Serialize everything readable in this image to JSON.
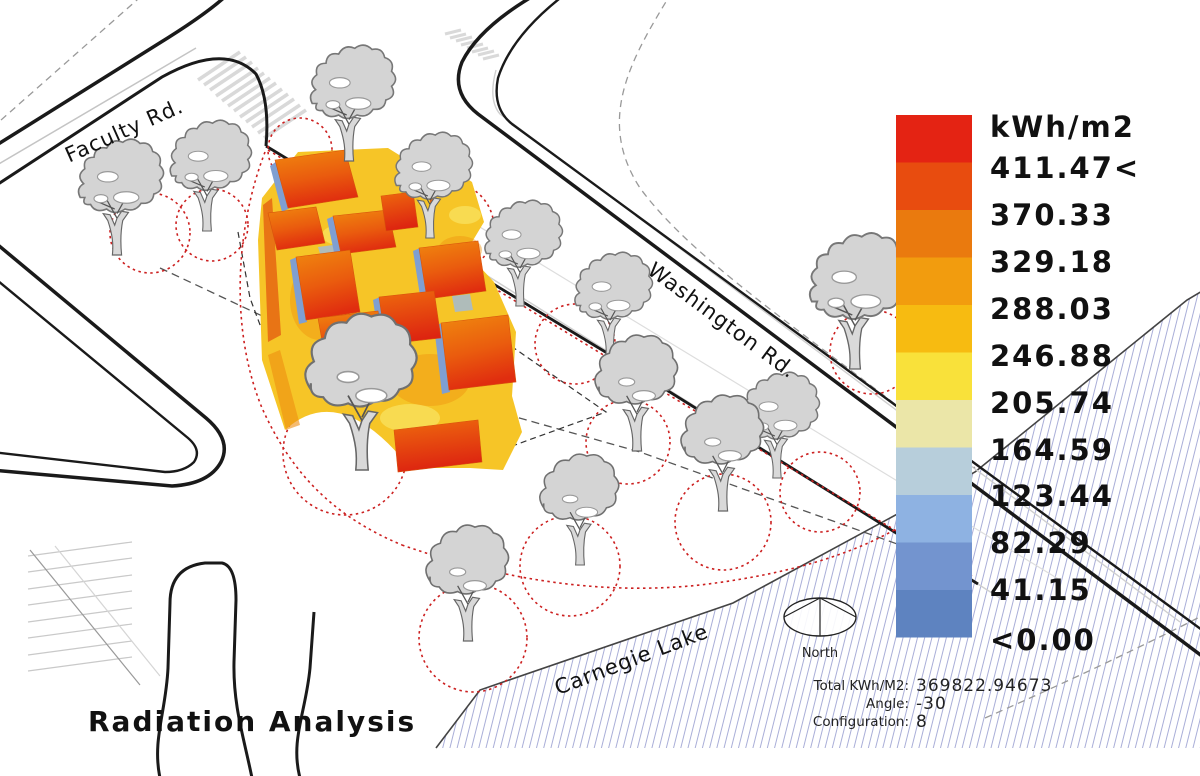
{
  "title": "Radiation Analysis",
  "legend": {
    "unit_label": "kWh/m2",
    "entries": [
      "411.47<",
      "370.33",
      "329.18",
      "288.03",
      "246.88",
      "205.74",
      "164.59",
      "123.44",
      "82.29",
      "41.15",
      "<0.00"
    ],
    "colors": [
      "#e42313",
      "#e84c0f",
      "#ea7a0e",
      "#f29c0e",
      "#f7bb11",
      "#f9e13a",
      "#ebe6a8",
      "#b7cedb",
      "#8eb2e2",
      "#7394cf",
      "#5e83c0"
    ]
  },
  "map_labels": {
    "road_top_left": "Faculty Rd.",
    "road_right": "Washington Rd.",
    "lake": "Carnegie Lake",
    "compass": "North"
  },
  "stats": {
    "total_label": "Total KWh/M2:",
    "total_value": "369822.94673",
    "angle_label": "Angle:",
    "angle_value": "-30",
    "config_label": "Configuration:",
    "config_value": "8"
  },
  "palette": {
    "site_ground": "#f6c527",
    "roof_orange": "#ee7d0e",
    "roof_red": "#e02d0f",
    "shadow_blue": "#7f9fd2",
    "tree_fill": "#d4d4d4",
    "tree_outline": "#777777",
    "dotted_red": "#cc2020",
    "road_black": "#1a1a1a",
    "lake_hatch": "#a9aed8"
  },
  "chart_data": {
    "type": "heatmap",
    "title": "Radiation Analysis",
    "unit": "kWh/m2",
    "legend_bins": [
      "411.47<",
      "370.33",
      "329.18",
      "288.03",
      "246.88",
      "205.74",
      "164.59",
      "123.44",
      "82.29",
      "41.15",
      "<0.00"
    ],
    "bin_colors": [
      "#e42313",
      "#e84c0f",
      "#ea7a0e",
      "#f29c0e",
      "#f7bb11",
      "#f9e13a",
      "#ebe6a8",
      "#b7cedb",
      "#8eb2e2",
      "#7394cf",
      "#5e83c0"
    ],
    "legend_position": "right",
    "total_kwh_m2": 369822.94673,
    "angle": -30,
    "configuration": 8
  }
}
